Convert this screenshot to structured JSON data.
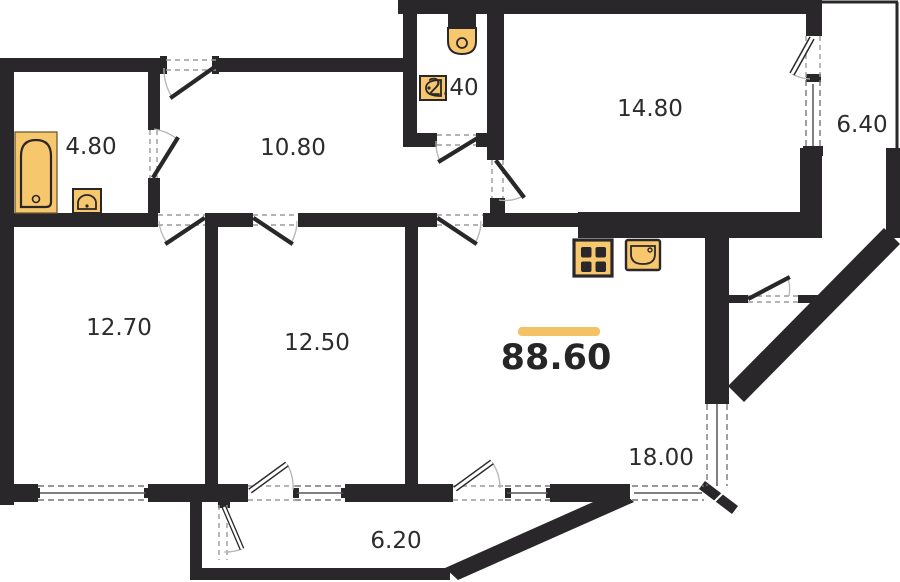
{
  "plan": {
    "labels": {
      "bathroom": "4.80",
      "hallway": "10.80",
      "wc": "2.40",
      "bedroom": "14.80",
      "balcony_right": "6.40",
      "room_left": "12.70",
      "room_mid": "12.50",
      "total_area": "88.60",
      "kitchen": "18.00",
      "balcony_bottom": "6.20"
    },
    "colors": {
      "wall": "#2a272a",
      "fixture_fill": "#F7C76D",
      "accent": "#F2C265",
      "text": "#2c2c2c",
      "door_dash": "#9b9b9b",
      "window_line": "#555555",
      "arc": "#b5b5b5"
    },
    "icons": [
      "bathtub-icon",
      "bathroom-sink-icon",
      "toilet-icon",
      "wc-sink-icon",
      "stove-icon",
      "kitchen-sink-icon"
    ]
  }
}
